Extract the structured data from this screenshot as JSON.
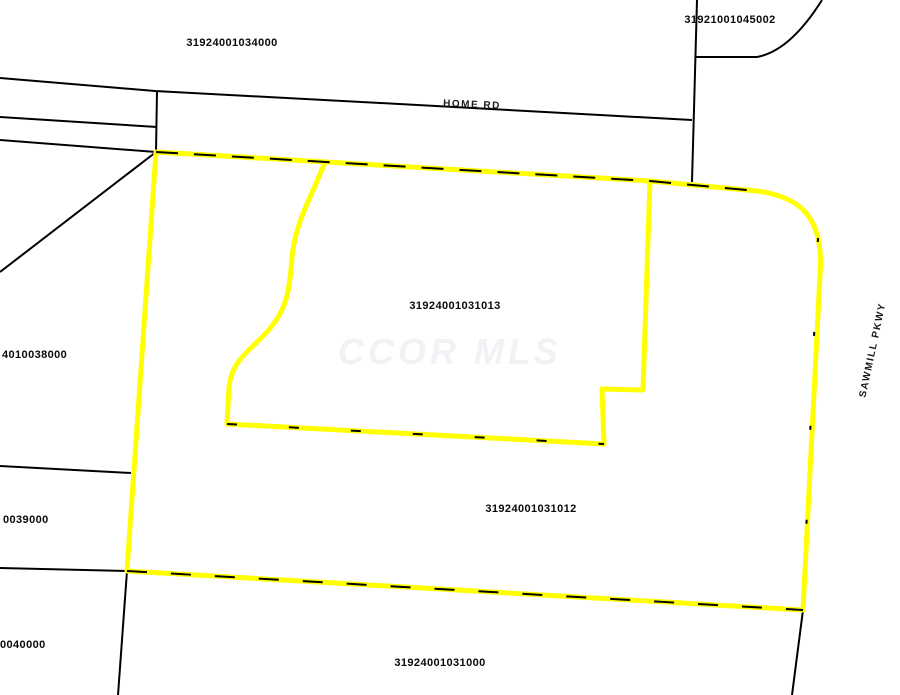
{
  "map": {
    "watermark_text": "CCOR MLS",
    "highlight_color": "#ffff00",
    "boundary_color": "#000000",
    "background_color": "#ffffff",
    "roads": {
      "home_rd": "HOME RD",
      "sawmill_pkwy": "SAWMILL PKWY"
    },
    "parcel_labels": {
      "top_left": "31924001034000",
      "top_right": "31921001045002",
      "center": "31924001031013",
      "center_lower": "31924001031012",
      "bottom_center": "31924001031000",
      "left_upper": "4010038000",
      "left_lower": "0039000",
      "bottom_left": "0040000"
    }
  }
}
